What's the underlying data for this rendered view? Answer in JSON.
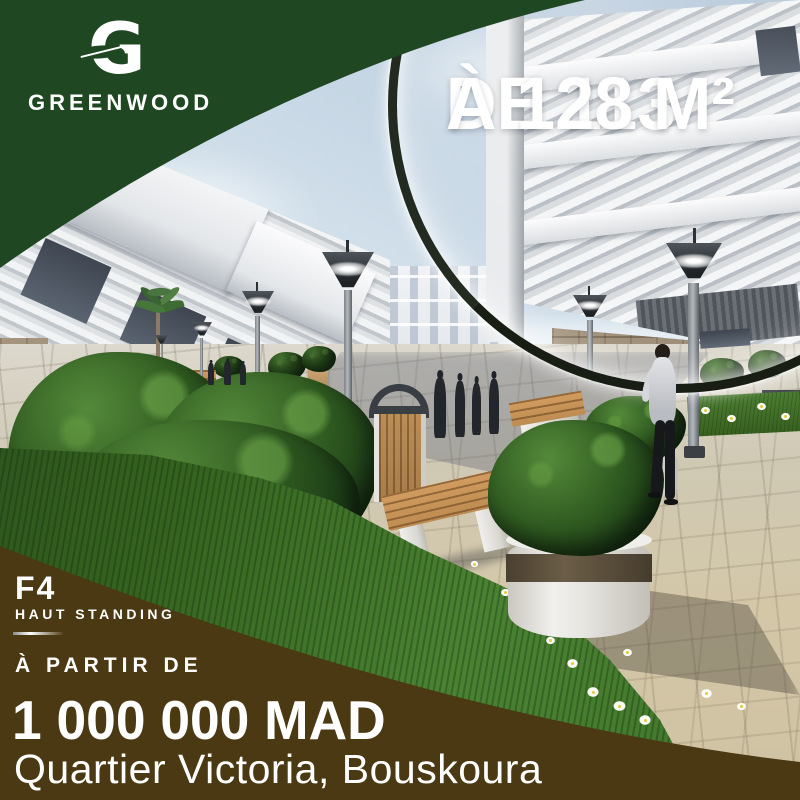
{
  "brand": {
    "monogram": "G",
    "name": "GREENWOOD"
  },
  "headline": {
    "line1": "DE 113",
    "line2": "À 128 M²"
  },
  "offer": {
    "unit_type": "F4",
    "quality": "HAUT STANDING",
    "price_label": "À PARTIR DE",
    "price": "1 000 000 MAD",
    "location": "Quartier Victoria, Bouskoura"
  },
  "colors": {
    "brand_green": "#1e4722",
    "brand_brown": "#4a3913",
    "text_white": "#ffffff",
    "lens_rim": "#232a1f"
  },
  "icons": {
    "logo": "greenwood-leaf-g-logo",
    "lens": "magnifier-lens"
  }
}
